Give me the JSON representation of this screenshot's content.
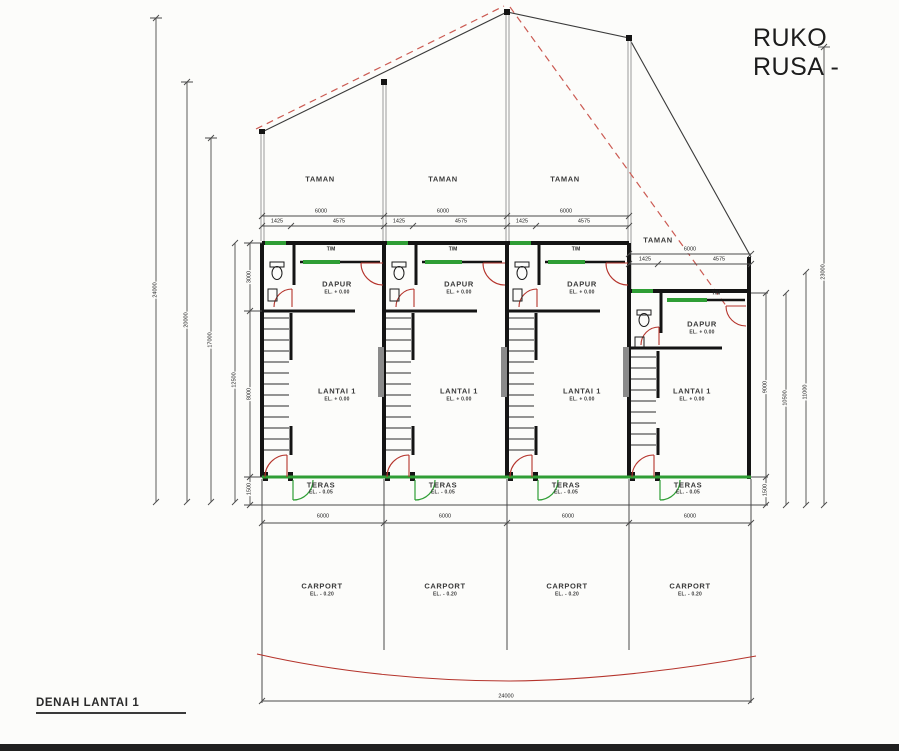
{
  "title": "RUKO RUSA -",
  "drawing_label": "DENAH LANTAI 1",
  "rooms": {
    "taman": "TAMAN",
    "tm": "T/M",
    "dapur": "DAPUR",
    "lantai1": "LANTAI 1",
    "teras": "TERAS",
    "carport": "CARPORT"
  },
  "elevations": {
    "ground": "EL. + 0.00",
    "teras": "EL. - 0.05",
    "carport": "EL. - 0.20"
  },
  "dimensions": {
    "unit_width": "6000",
    "unit_split_a": "1425",
    "unit_split_b": "4575",
    "carport_width": "6000",
    "total_width": "24000",
    "left_overall": "24000",
    "left_mid": "20000",
    "left_inner": "17000",
    "left_building": "12500",
    "chain_dapur": "3000",
    "chain_lantai": "8000",
    "chain_teras": "1500",
    "right_lantai": "9000",
    "right_teras": "1500",
    "right_building": "10500",
    "right_inner": "11000",
    "right_overall": "23000"
  },
  "colors": {
    "background": "#fcfcfa",
    "green": "#2f9e35",
    "red": "#b5342c",
    "reddash": "#cb5a52",
    "footer": "#202020"
  }
}
